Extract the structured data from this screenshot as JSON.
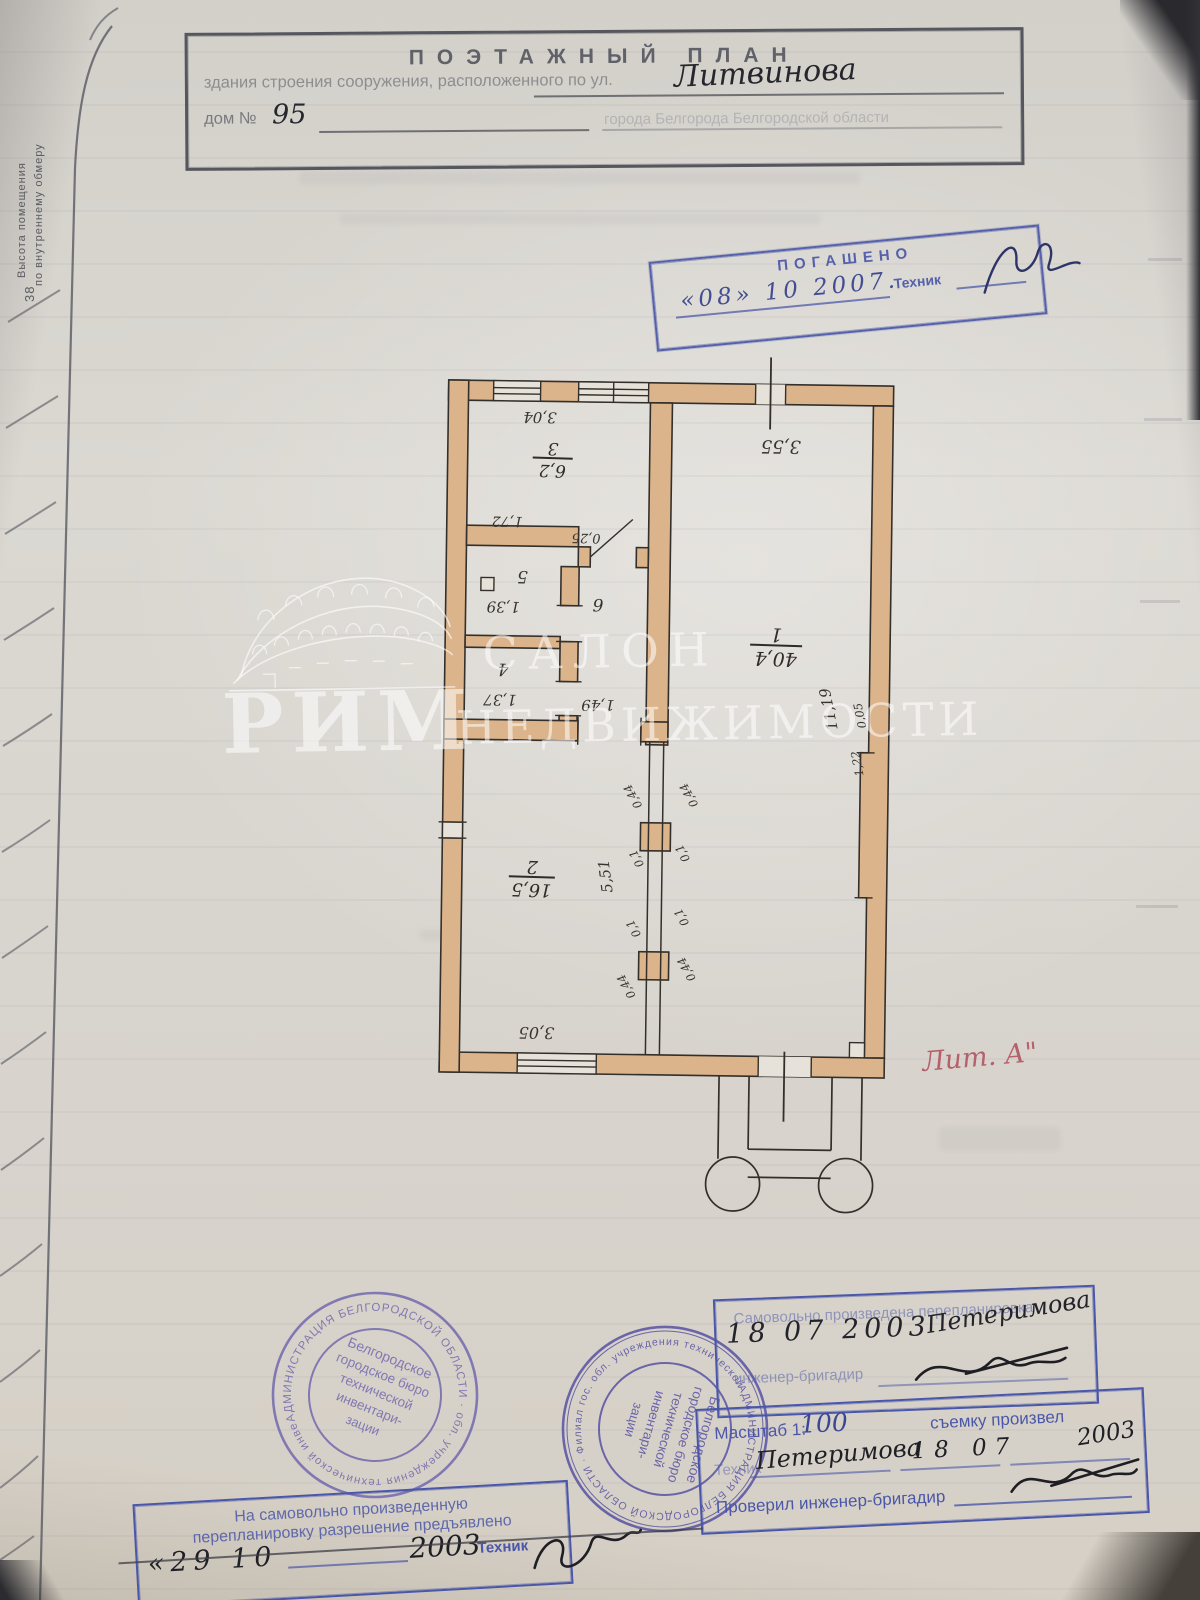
{
  "margin": {
    "vertical_label_line1": "Высота помещения",
    "vertical_label_line2": "по внутреннему обмеру",
    "page_number": "38"
  },
  "header": {
    "title": "ПОЭТАЖНЫЙ ПЛАН",
    "line2_printed": "здания строения сооружения, расположенного по ул.",
    "line2_handwritten": "Литвинова",
    "line3_label": "дом №",
    "line3_handwritten": "95",
    "line3_faint": "города Белгорода Белгородской области"
  },
  "cancel_stamp": {
    "title": "ПОГАШЕНО",
    "date_handwritten": "«08»  10   2007.",
    "tech_label": "Техник"
  },
  "watermark": {
    "brand": "РИМ",
    "word1": "САЛОН",
    "word2": "НЕДВИЖИМОСТИ"
  },
  "plan": {
    "liter": "Лит. А\"",
    "rooms": {
      "r1": {
        "number": "1",
        "area": "40,4"
      },
      "r2": {
        "number": "2",
        "area": "16,5"
      },
      "r3": {
        "number": "3",
        "area": "6,2"
      },
      "r4": {
        "number": "4"
      },
      "r5": {
        "number": "5"
      },
      "r6": {
        "number": "6"
      }
    },
    "dims": {
      "top_left": "3,04",
      "top_right": "3,55",
      "mid_left": "1,72",
      "jog": "0,25",
      "room5_width": "1,39",
      "room4_width": "1,37",
      "hall_width": "1,49",
      "room2_height": "5,51",
      "room2_width": "3,05",
      "room1_height": "11,19",
      "niche_depth": "0,05",
      "niche_width": "1,22",
      "pillar_size": "0,44",
      "pillar_offset": "0,1"
    }
  },
  "round_stamp_left": {
    "ring_text": "АДМИНИСТРАЦИЯ  БЕЛГОРОДСКОЙ  ОБЛАСТИ  ·  обл. учреждения технической инвентаризации",
    "center_lines": [
      "Белгородское",
      "городское бюро",
      "технической",
      "инвентари-",
      "зации"
    ]
  },
  "round_stamp_center": {
    "ring_text": "АДМИНИСТРАЦИЯ БЕЛГОРОДСКОЙ ОБЛАСТИ · Филиал гос. обл. учреждения технической инвентаризации",
    "center_lines": [
      "Белгородское",
      "городское бюро",
      "технической",
      "инвентари-",
      "зации"
    ]
  },
  "remodel_stamp": {
    "line1": "Самовольно произведена перепланировка",
    "date_handwritten": "18  07  2003",
    "name_handwritten": "Петеримова",
    "line2": "инженер-бригадир"
  },
  "scale_stamp": {
    "scale_label": "Масштаб 1:",
    "scale_value": "100",
    "survey_label": "съемку произвел",
    "tech_label": "Техник",
    "tech_handwritten": "Петеримова",
    "date_handwritten": "18    07",
    "year_handwritten": "2003",
    "check_label": "Проверил инженер-бригадир"
  },
  "permit_stamp": {
    "line1": "На самовольно произведенную",
    "line2": "перепланировку разрешение предъявлено",
    "date_handwritten": "«29   10",
    "year_handwritten": "2003",
    "tech_label": "Техник"
  }
}
